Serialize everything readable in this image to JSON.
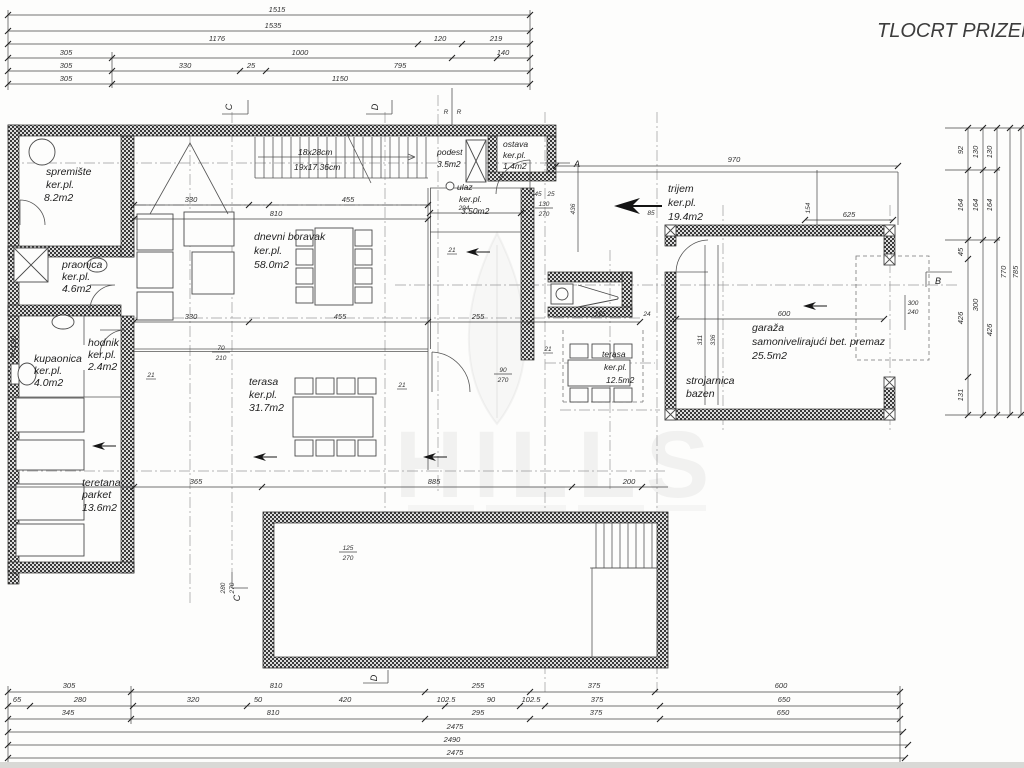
{
  "title": "TLOCRT PRIZEMLJA",
  "watermark": {
    "brand": "HILLS"
  },
  "rooms": {
    "spremiste": {
      "name": "spremište",
      "floor": "ker.pl.",
      "area": "8.2m2"
    },
    "praonica": {
      "name": "praonica",
      "floor": "ker.pl.",
      "area": "4.6m2"
    },
    "kupaonica": {
      "name": "kupaonica",
      "floor": "ker.pl.",
      "area": "4.0m2"
    },
    "hodnik": {
      "name": "hodnik",
      "floor": "ker.pl.",
      "area": "2.4m2"
    },
    "teretana": {
      "name": "teretana",
      "floor": "parket",
      "area": "13.6m2"
    },
    "dnevni_boravak": {
      "name": "dnevni boravak",
      "floor": "ker.pl.",
      "area": "58.0m2"
    },
    "terasa_velika": {
      "name": "terasa",
      "floor": "ker.pl.",
      "area": "31.7m2"
    },
    "terasa_mala": {
      "name": "terasa",
      "floor": "ker.pl.",
      "area": "12.5m2"
    },
    "ulaz": {
      "name": "ulaz",
      "floor": "ker.pl.",
      "area": "3.50m2"
    },
    "podest": {
      "name": "podest",
      "area": "3.5m2"
    },
    "ostava": {
      "name": "ostava",
      "floor": "ker.pl.",
      "area": "1.4m2"
    },
    "trijem": {
      "name": "trijem",
      "floor": "ker.pl.",
      "area": "19.4m2"
    },
    "garaza": {
      "name": "garaža",
      "note": "samonivelirajući bet. premaz",
      "area": "25.5m2"
    },
    "strojarnica": {
      "name": "strojarnica",
      "note": "bazen"
    }
  },
  "stairs": {
    "spec1": "18x28cm",
    "spec2": "19x17.36cm"
  },
  "markers": {
    "a": "A",
    "b": "B",
    "c": "C",
    "d": "D",
    "r": "R",
    "parapet": "P=190"
  },
  "dims": {
    "top": {
      "row1": [
        "1515"
      ],
      "row2": [
        "1535"
      ],
      "row3": [
        "1176",
        "120",
        "219"
      ],
      "row4": [
        "305",
        "1000",
        "140"
      ],
      "row5": [
        "305",
        "330",
        "25",
        "795"
      ],
      "row6": [
        "305",
        "1150"
      ]
    },
    "bottom": {
      "row1": [
        "305",
        "810",
        "255",
        "375",
        "600"
      ],
      "row2": [
        "65",
        "280",
        "320",
        "50",
        "420",
        "102.5",
        "90",
        "102.5",
        "375",
        "650"
      ],
      "row3": [
        "345",
        "810",
        "295",
        "375",
        "650"
      ],
      "row4": [
        "2475"
      ],
      "row5": [
        "2490"
      ],
      "row6": [
        "2475"
      ]
    },
    "right": {
      "col1": [
        "92",
        "164",
        "45",
        "426",
        "131"
      ],
      "col2": [
        "130",
        "164",
        "300"
      ],
      "col3": [
        "130",
        "164",
        "426"
      ],
      "col4": [
        "770"
      ],
      "col5": [
        "785"
      ]
    },
    "interior": [
      "330",
      "455",
      "810",
      "294",
      "330",
      "455",
      "255",
      "365",
      "885",
      "200",
      "970",
      "625",
      "154",
      "600",
      "300",
      "240",
      "311",
      "336",
      "436",
      "85",
      "45",
      "25",
      "130",
      "270",
      "70",
      "210",
      "90",
      "270",
      "125",
      "270",
      "280",
      "270",
      "21",
      "21",
      "21",
      "21",
      "21",
      "175",
      "24"
    ]
  }
}
